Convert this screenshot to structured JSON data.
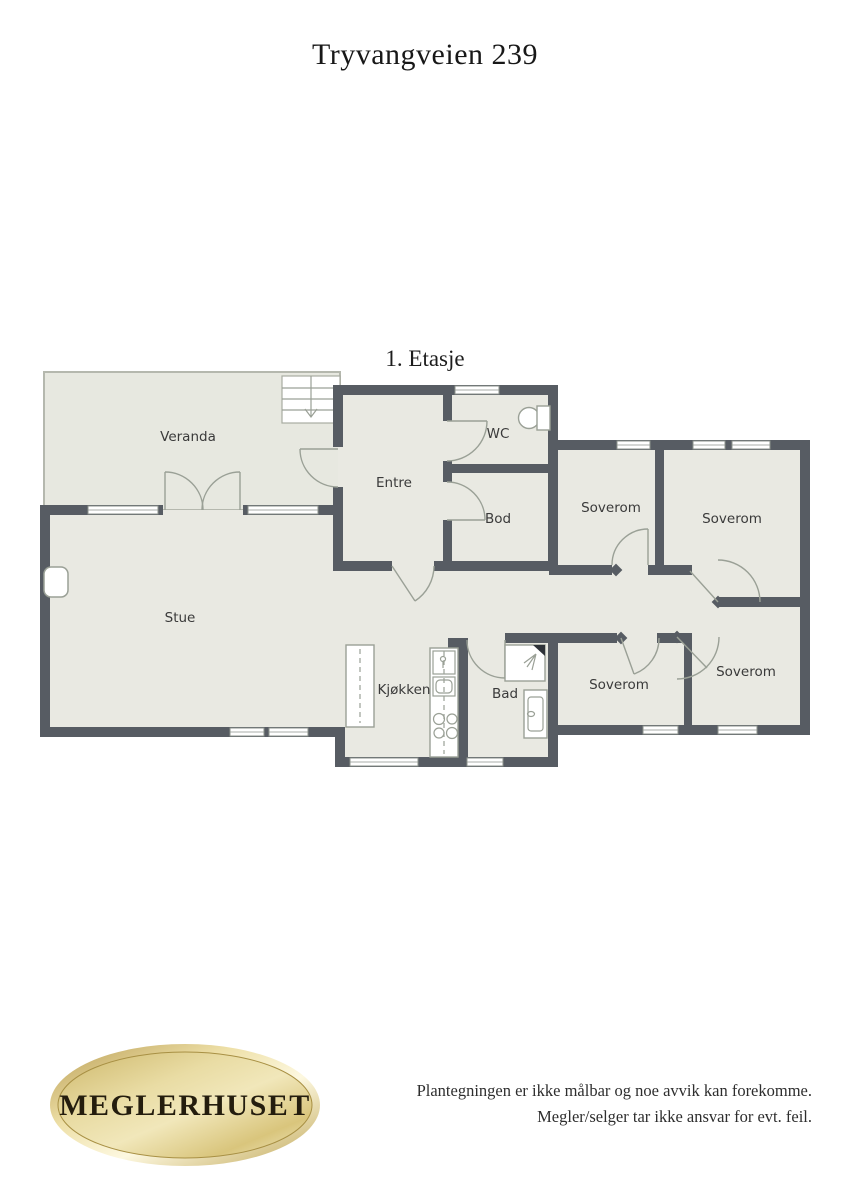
{
  "page": {
    "title": "Tryvangveien 239",
    "floor_label": "1. Etasje"
  },
  "floorplan": {
    "rooms": [
      {
        "id": "veranda",
        "label": "Veranda"
      },
      {
        "id": "entre",
        "label": "Entre"
      },
      {
        "id": "wc",
        "label": "WC"
      },
      {
        "id": "bod",
        "label": "Bod"
      },
      {
        "id": "soverom-1",
        "label": "Soverom"
      },
      {
        "id": "soverom-2",
        "label": "Soverom"
      },
      {
        "id": "stue",
        "label": "Stue"
      },
      {
        "id": "kjokken",
        "label": "Kjøkken"
      },
      {
        "id": "bad",
        "label": "Bad"
      },
      {
        "id": "soverom-3",
        "label": "Soverom"
      },
      {
        "id": "soverom-4",
        "label": "Soverom"
      }
    ],
    "colors": {
      "wall": "#575c63",
      "floor": "#e9e9e2",
      "door_line": "#9aa096"
    }
  },
  "footer": {
    "logo_text": "MEGLERHUSET",
    "disclaimer_line1": "Plantegningen er ikke målbar og noe avvik kan forekomme.",
    "disclaimer_line2": "Megler/selger tar ikke ansvar for evt. feil."
  }
}
